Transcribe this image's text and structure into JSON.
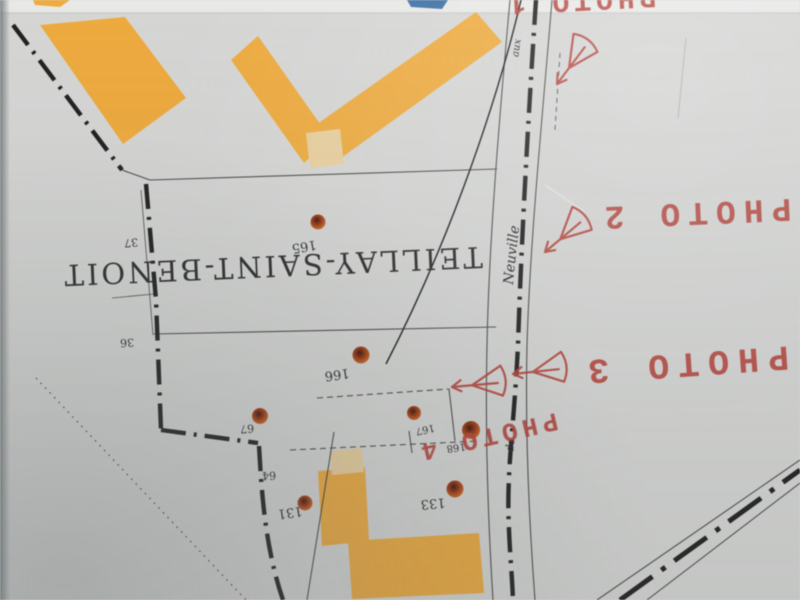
{
  "commune": {
    "label": "TEILLAY-SAINT-BENOIT"
  },
  "street": {
    "aux": "aux",
    "name": "Neuville",
    "de": "de"
  },
  "photos": {
    "p1": "PHOTO 1",
    "p2": "PHOTO 2",
    "p3": "PHOTO 3",
    "p4": "PHOTO 4"
  },
  "parcels": {
    "n37": "37",
    "n36": "36",
    "n67": "67",
    "n64": "64"
  },
  "addresses": {
    "n165": "165",
    "n166": "166",
    "n167": "167",
    "n168": "168",
    "n133": "133",
    "n131": "131"
  },
  "icons": {
    "camera_direction": "view-cone-with-arrow"
  },
  "colors": {
    "paper": "#d6d7d5",
    "building": "#eeab3f",
    "building_light": "#e9d09e",
    "blue": "#3d6fa5",
    "red": "#b5443c",
    "ink": "#2e2e2e",
    "dot": "#8e3413"
  }
}
